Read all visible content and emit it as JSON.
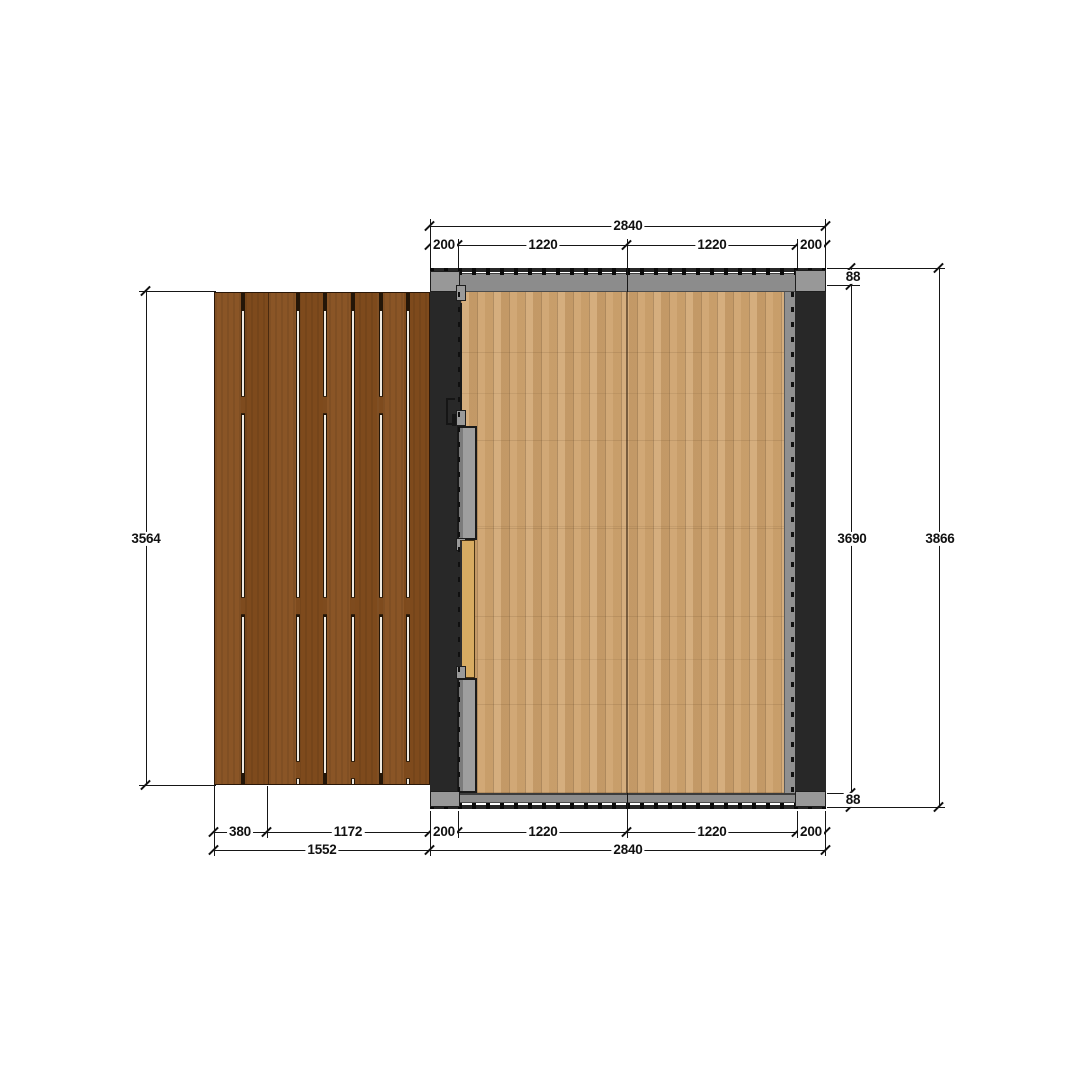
{
  "drawing": {
    "type": "floor-plan-top-view",
    "subject": "garden room with glazed walls, sliding door and side deck terrace"
  },
  "dims": {
    "top_total": "2840",
    "top_segs": [
      "200",
      "1220",
      "1220",
      "200"
    ],
    "bottom_deck_segs": [
      "380",
      "1172"
    ],
    "bottom_segs": [
      "200",
      "1220",
      "1220",
      "200"
    ],
    "bottom_deck_total": "1552",
    "bottom_total": "2840",
    "left_height": "3564",
    "right_offset_top": "88",
    "right_inner": "3690",
    "right_total": "3866",
    "right_offset_bottom": "88"
  },
  "colors": {
    "deck_wood": "#85511f",
    "floor_wood": "#cfa470",
    "wall_black": "#282828",
    "frame_gray": "#8c8c8c",
    "door_gray": "#9e9e9e",
    "threshold_tan": "#d8ac62",
    "dimension_line": "#161616"
  }
}
